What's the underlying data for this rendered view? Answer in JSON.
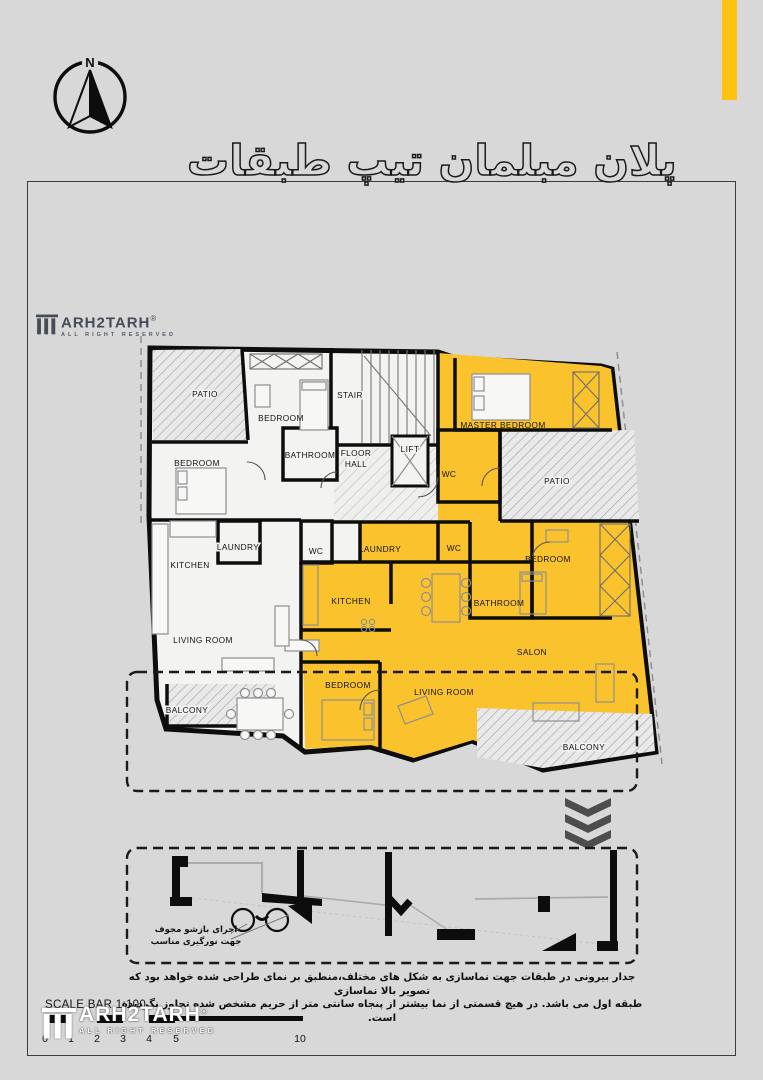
{
  "poster": {
    "title": "پلان مبلمان تیپ طبقات",
    "compass_label": "N",
    "colors": {
      "background": "#D8D8D8",
      "accent_bar": "#FFC20E",
      "unit_highlight": "#FAC32D",
      "walls": "#111111"
    }
  },
  "plan": {
    "rooms": [
      "PATIO",
      "BEDROOM",
      "STAIR",
      "MASTER BEDROOM",
      "BEDROOM",
      "BATHROOM",
      "FLOOR",
      "HALL",
      "LIFT",
      "WC",
      "PATIO",
      "LAUNDRY",
      "WC",
      "LAUNDRY",
      "KITCHEN",
      "WC",
      "BEDROOM",
      "KITCHEN",
      "BATHROOM",
      "LIVING ROOM",
      "SALON",
      "BEDROOM",
      "LIVING ROOM",
      "BALCONY",
      "BALCONY"
    ]
  },
  "detail": {
    "annotation_line1": "اجرای بازشو مجوف",
    "annotation_line2": "جهت نورگیری مناسب"
  },
  "note": {
    "line1": "جدار بیرونی در طبقات جهت نماسازی به شکل های مختلف،منطبق بر نمای طراحی شده خواهد بود که تصویر بالا نماسازی",
    "line2": "طبقه اول می باشد. در هیچ قسمتی از نما بیشتر از پنجاه سانتی متر از حریم مشخص شده تجاوز نگردیده است."
  },
  "scale": {
    "label": "SCALE BAR 1:100",
    "numbers": [
      "0",
      "1",
      "2",
      "3",
      "4",
      "5",
      "10"
    ]
  },
  "watermark": {
    "brand": "ARH2TARH",
    "registered": "®",
    "tagline": "ALL RIGHT RESERVED"
  }
}
